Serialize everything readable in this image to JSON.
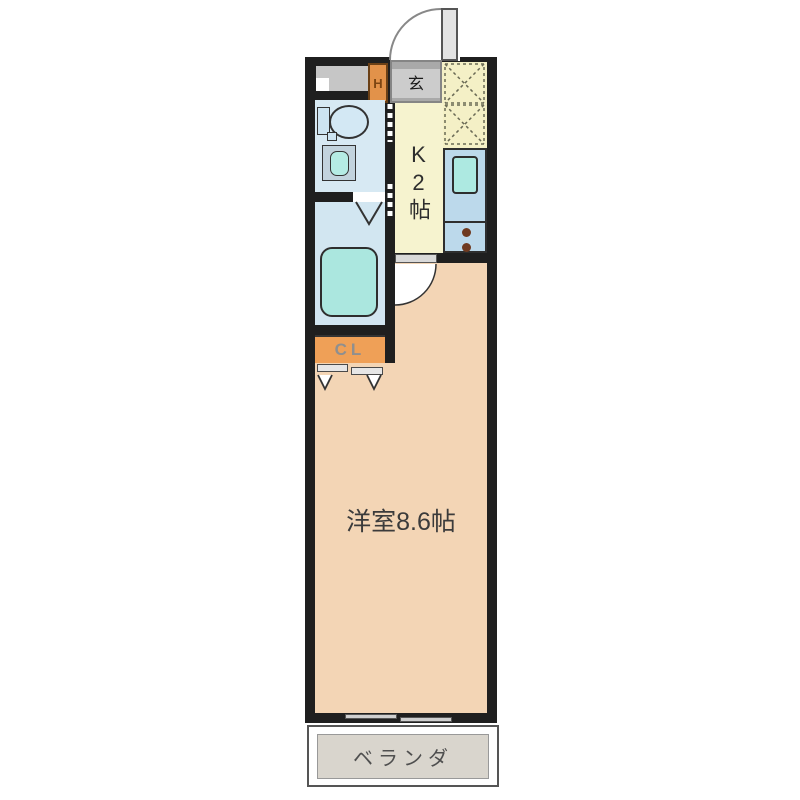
{
  "plan": {
    "type": "japanese-apartment-floorplan",
    "labels": {
      "entrance_hall": "玄",
      "water_heater": "H",
      "kitchen": "K2帖",
      "closet": "CL",
      "western_room": "洋室8.6帖",
      "veranda": "ベランダ"
    },
    "colors": {
      "wall": "#1f1f1f",
      "western_room_floor": "#f3d5b5",
      "kitchen_floor": "#f6f3cf",
      "entrance_tile": "#f4f0c6",
      "wet_area_floor": "#d5e8f2",
      "bathtub": "#abe7df",
      "kitchen_counter": "#bcd9eb",
      "sink": "#ade9e1",
      "closet": "#efa057",
      "water_heater": "#e2924a",
      "veranda": "#d9d5cd",
      "entrance_mat": "#c9c9c9",
      "burner": "#6f3a20"
    },
    "fixtures": [
      "entrance-door",
      "shoe-step",
      "water-heater",
      "entrance-tile",
      "toilet",
      "washbasin",
      "folding-door",
      "bathtub",
      "kitchen-counter",
      "kitchen-sink",
      "gas-burners",
      "room-door",
      "closet-sliding-doors",
      "window",
      "veranda"
    ]
  }
}
